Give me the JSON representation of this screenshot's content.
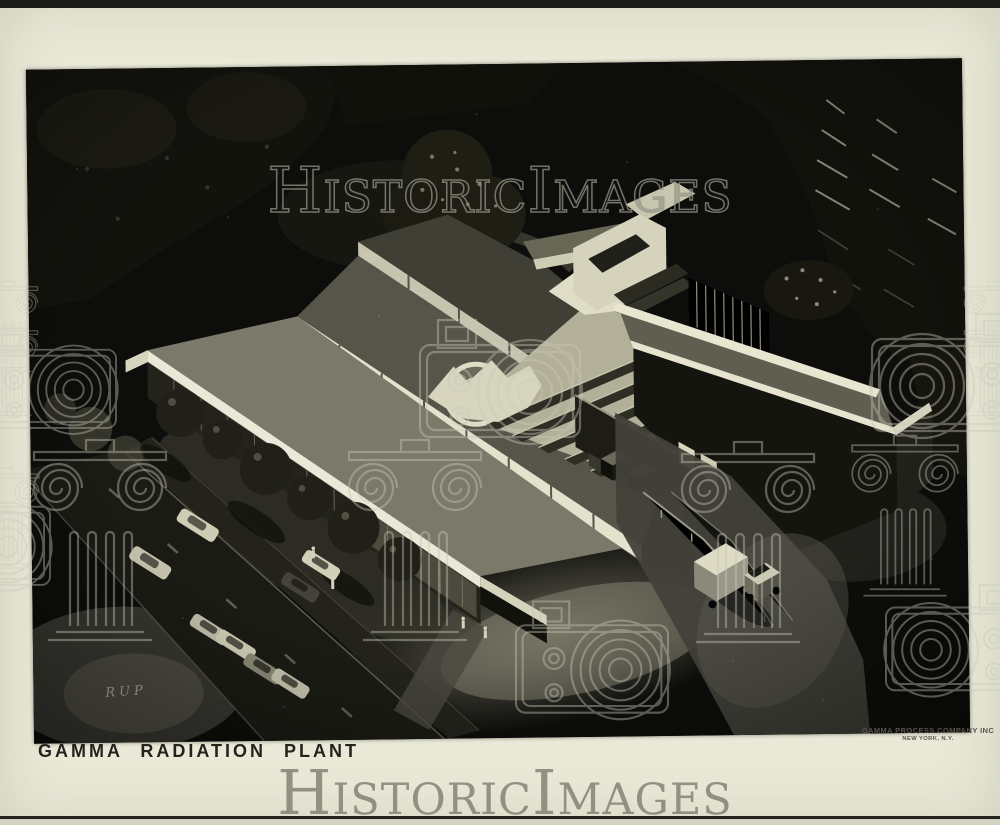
{
  "frame": {
    "caption": "GAMMA RADIATION PLANT"
  },
  "photo": {
    "signature": "RUP"
  },
  "stamp": {
    "line1": "GAMMA PROCESS COMPANY INC",
    "line2": "NEW YORK, N.Y."
  },
  "watermark": {
    "text": "HistoricImages"
  },
  "colors": {
    "paper": "#eae9d7",
    "photo_background": "#0d0d0b",
    "building_white": "#e8e5d0",
    "roof_gray": "#7b7969",
    "watermark_gray": "#8b8a7c",
    "caption_ink": "#24241f"
  }
}
